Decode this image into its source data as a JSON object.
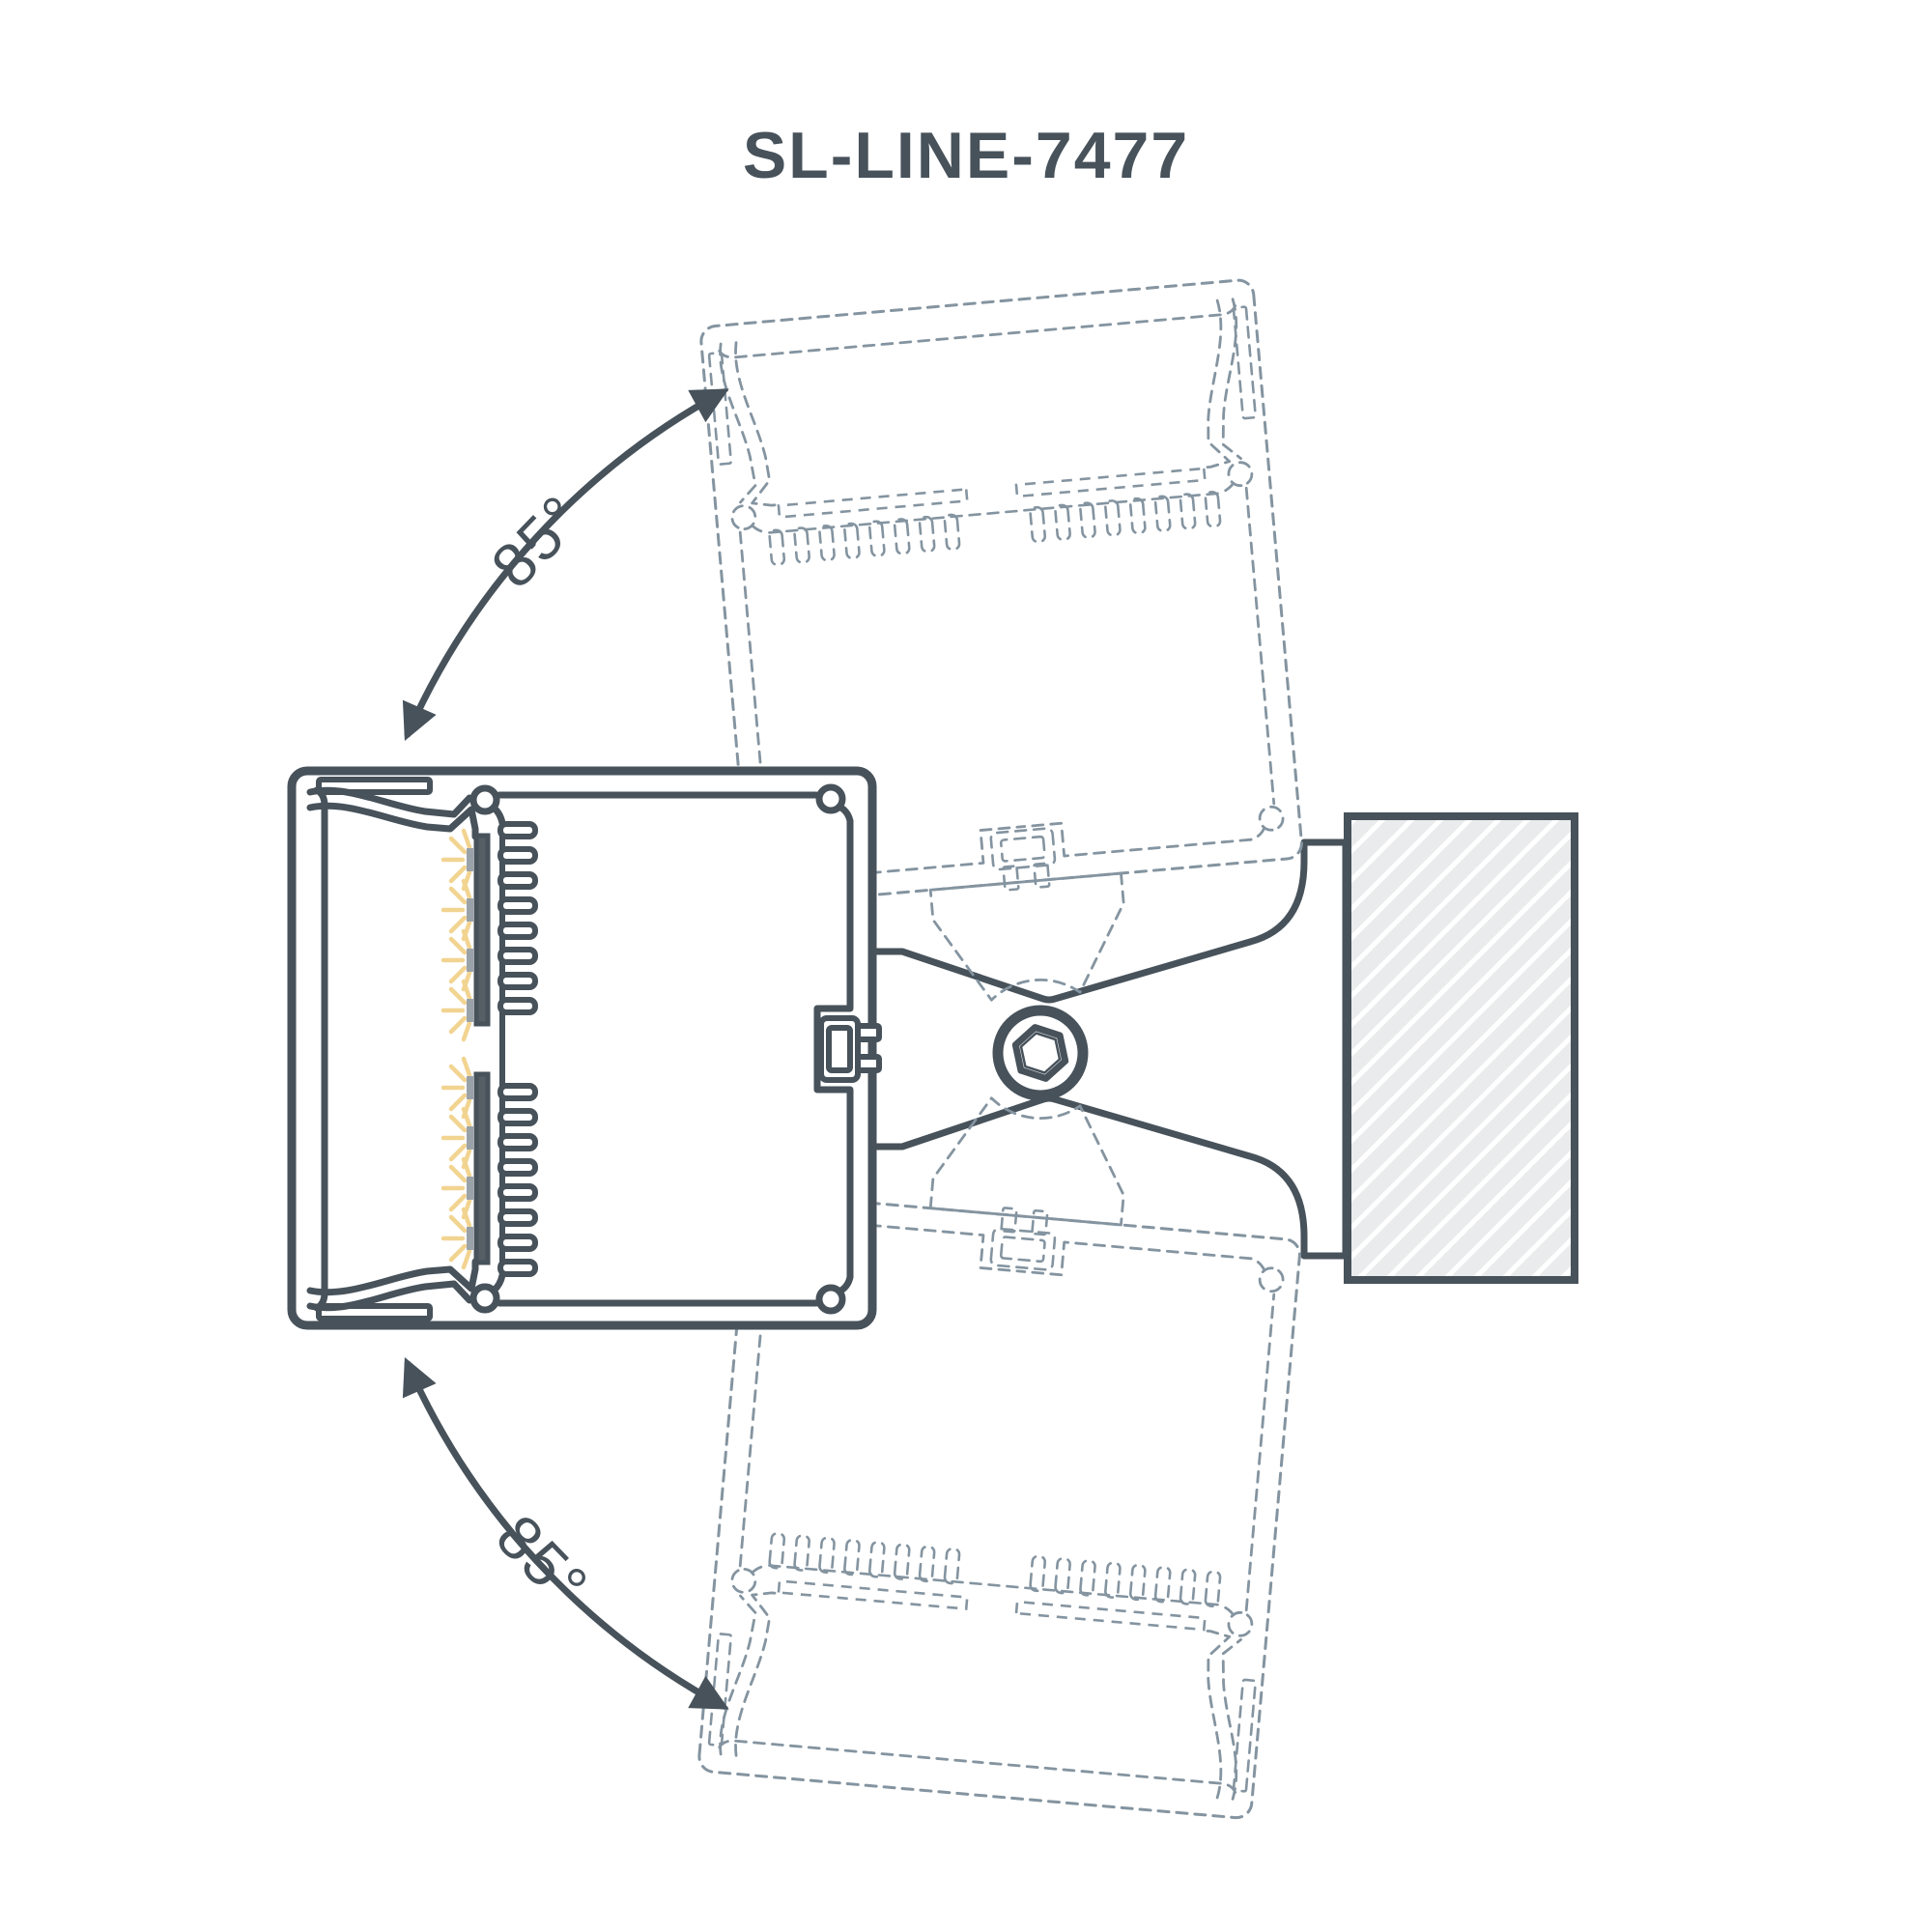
{
  "title": "SL-LINE-7477",
  "labels": {
    "angle_top": "85°",
    "angle_bottom": "85°"
  },
  "colors": {
    "line": "#47525b",
    "ghost": "#8494a0",
    "ray": "#f2d491",
    "tick": "#9aa2a9",
    "pcb": "#575f66",
    "block_fill": "#eaebec",
    "hatch_line": "#ffffff",
    "background": "#ffffff"
  }
}
